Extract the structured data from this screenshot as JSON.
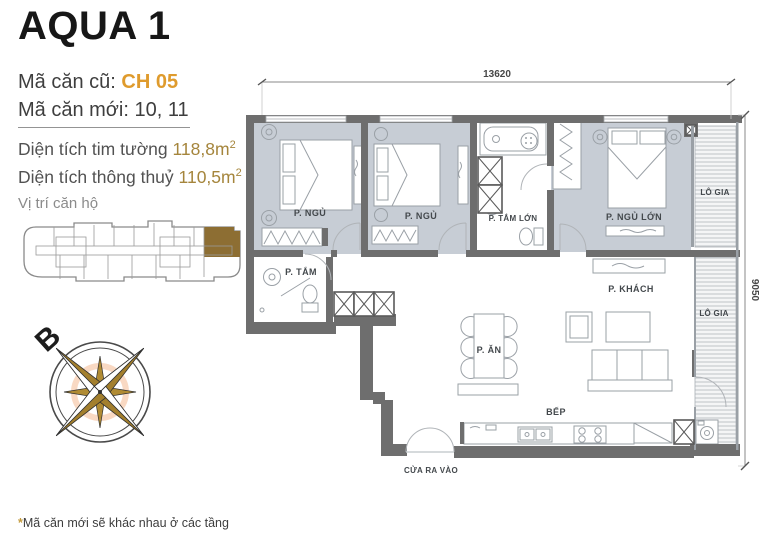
{
  "header": {
    "title": "AQUA 1",
    "old_code_label": "Mã căn cũ: ",
    "old_code_value": "CH 05",
    "new_code_label": "Mã căn mới: ",
    "new_code_value": "10, 11"
  },
  "areas": {
    "gross_label": "Diện tích tim tường ",
    "gross_value": "118,8m",
    "gross_sup": "2",
    "net_label": "Diện tích thông thuỷ ",
    "net_value": "110,5m",
    "net_sup": "2"
  },
  "location_section": {
    "label": "Vị trí căn hộ"
  },
  "compass": {
    "north": "B"
  },
  "plan": {
    "dim_width": "13620",
    "dim_height": "9050",
    "rooms": {
      "bedroom1": {
        "label": "P. NGỦ"
      },
      "bedroom2": {
        "label": "P. NGỦ"
      },
      "bath_large": {
        "label": "P. TẮM LỚN"
      },
      "master": {
        "label": "P. NGỦ LỚN"
      },
      "loggia_top": {
        "label": "LÔ GIA"
      },
      "bath_small": {
        "label": "P. TẮM"
      },
      "living": {
        "label": "P. KHÁCH"
      },
      "dining": {
        "label": "P. ĂN"
      },
      "loggia_right": {
        "label": "LÔ GIA"
      },
      "kitchen": {
        "label": "BẾP"
      },
      "entrance": {
        "label": "CỬA RA VÀO"
      }
    }
  },
  "footnote": {
    "asterisk": "*",
    "text": "Mã căn mới sẽ khác nhau ở các tầng"
  },
  "colors": {
    "accent_gold": "#DF9B2D",
    "area_gold": "#A5853C",
    "unit_highlight": "#8D6E33",
    "wall_gray": "#6E6E6E",
    "room_fill": "#C7CDD5"
  }
}
